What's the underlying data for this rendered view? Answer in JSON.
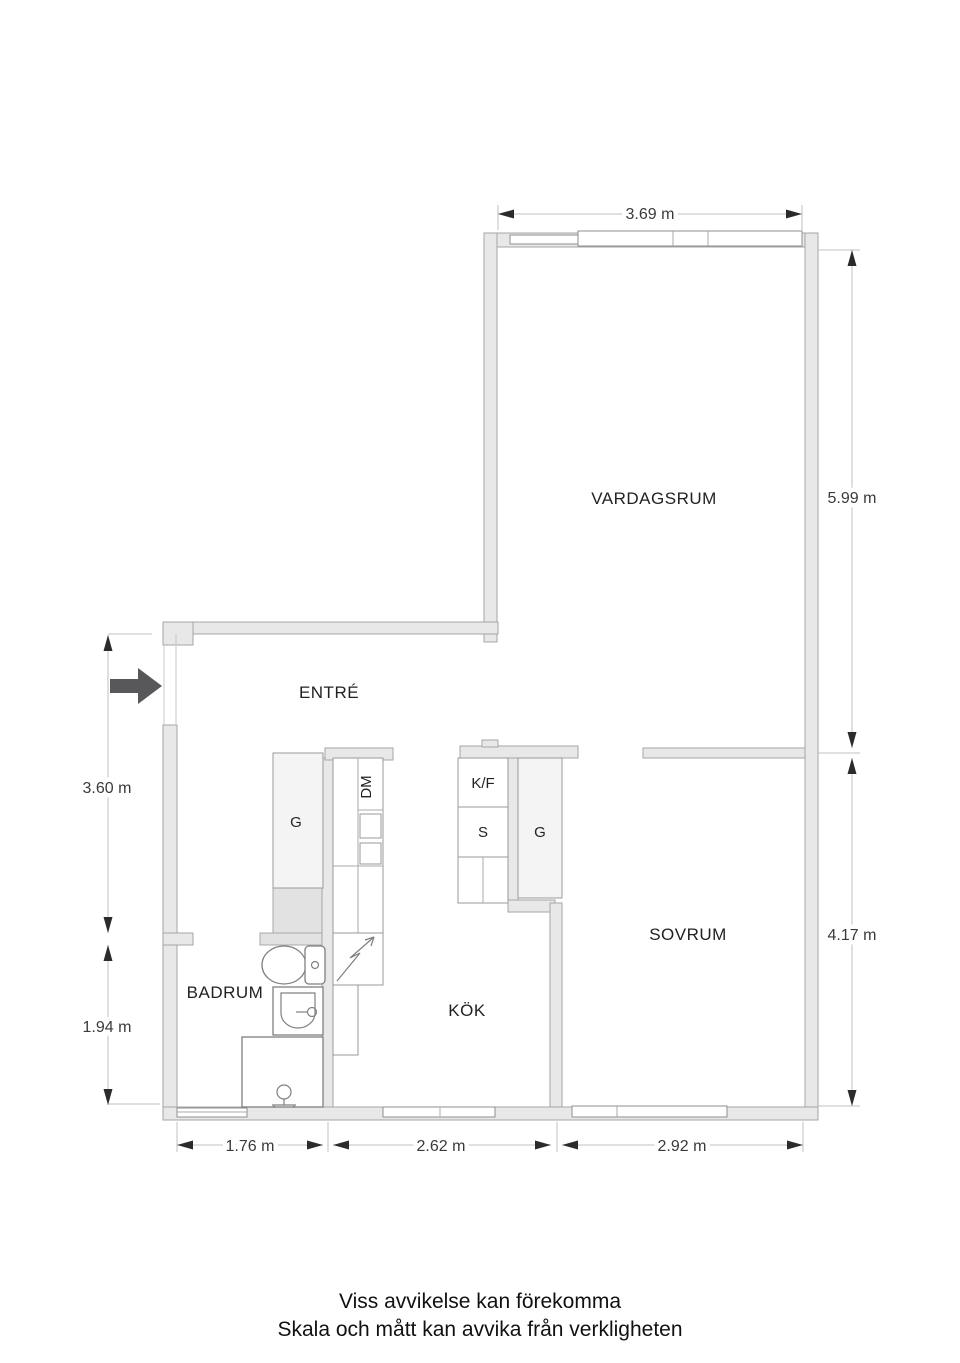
{
  "plan": {
    "rooms": [
      {
        "id": "vardagsrum",
        "label": "VARDAGSRUM"
      },
      {
        "id": "entre",
        "label": "ENTRÉ"
      },
      {
        "id": "badrum",
        "label": "BADRUM"
      },
      {
        "id": "kok",
        "label": "KÖK"
      },
      {
        "id": "sovrum",
        "label": "SOVRUM"
      }
    ],
    "fixtures": [
      {
        "id": "wardrobe-entre",
        "label": "G"
      },
      {
        "id": "dishwasher",
        "label": "DM"
      },
      {
        "id": "fridge-freezer",
        "label": "K/F"
      },
      {
        "id": "cabinet",
        "label": "S"
      },
      {
        "id": "wardrobe-sovrum",
        "label": "G"
      }
    ],
    "dimensions": {
      "top": "3.69 m",
      "right_upper": "5.99 m",
      "right_lower": "4.17 m",
      "left_upper": "3.60 m",
      "left_lower": "1.94 m",
      "bottom_left": "1.76 m",
      "bottom_middle": "2.62 m",
      "bottom_right": "2.92 m"
    },
    "disclaimer": [
      "Viss avvikelse kan förekomma",
      "Skala och mått kan avvika från verkligheten"
    ],
    "colors": {
      "wall_fill": "#e8e8e8",
      "wall_stroke": "#a6a6a6",
      "closet_fill": "#f4f4f4",
      "shaft_fill": "#e2e2e2",
      "entry_arrow": "#58585a",
      "dim_line": "#c2c2c2",
      "text": "#303030"
    }
  }
}
